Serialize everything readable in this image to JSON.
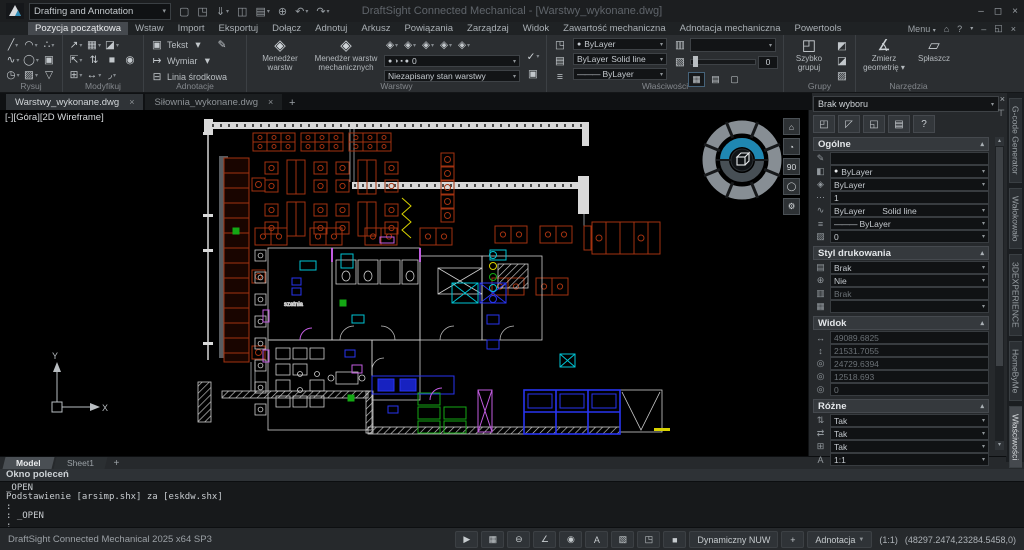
{
  "colors": {
    "accent_blue": "#1f87b2",
    "canvas_bg": "#000000",
    "equipment_red": "#a23210",
    "cyan": "#00c4d4",
    "blue": "#2834f0",
    "green": "#14a814",
    "magenta": "#c25ce0",
    "yellow": "#d8d200"
  },
  "titlebar": {
    "workspace": "Drafting and Annotation",
    "title": "DraftSight Connected Mechanical - [Warstwy_wykonane.dwg]",
    "qat": [
      [
        "▢",
        0
      ],
      [
        "◳",
        0
      ],
      [
        "⇓",
        1
      ],
      [
        "◫",
        0
      ],
      [
        "▤",
        1
      ],
      [
        "⊕",
        0
      ],
      [
        "↶",
        1
      ],
      [
        "↷",
        1
      ]
    ],
    "win": {
      "min": "–",
      "max": "◻",
      "close": "×"
    }
  },
  "menubar": {
    "tabs": [
      "Pozycja początkowa",
      "Wstaw",
      "Import",
      "Eksportuj",
      "Dołącz",
      "Adnotuj",
      "Arkusz",
      "Powiązania",
      "Zarządzaj",
      "Widok",
      "Zawartość mechaniczna",
      "Adnotacja mechaniczna",
      "Powertools"
    ],
    "active_index": 0,
    "menu_label": "Menu",
    "right_glyphs": [
      "▾",
      "⌂",
      "?",
      "▾",
      "–",
      "◱",
      "×"
    ]
  },
  "ribbon": {
    "labels": {
      "rysuj": "Rysuj",
      "modyfikuj": "Modyfikuj",
      "adnotacje": "Adnotacje",
      "warstwy": "Warstwy",
      "wlasciwosci": "Właściwości",
      "grupy": "Grupy",
      "narzedzia": "Narzędzia"
    },
    "rysuj_rows": [
      [
        [
          "╱",
          1
        ],
        [
          "◠",
          1
        ],
        [
          "∴",
          1
        ]
      ],
      [
        [
          "∿",
          1
        ],
        [
          "◯",
          1
        ],
        [
          "▣",
          0
        ]
      ],
      [
        [
          "◷",
          1
        ],
        [
          "▨",
          1
        ],
        [
          "▽",
          0
        ]
      ]
    ],
    "modyfikuj_rows": [
      [
        [
          "↗",
          1
        ],
        [
          "▦",
          1
        ],
        [
          "◪",
          1
        ]
      ],
      [
        [
          "⇱",
          1
        ],
        [
          "⇅",
          0
        ],
        [
          "■",
          0
        ],
        [
          "◉",
          0
        ]
      ],
      [
        [
          "⊞",
          1
        ],
        [
          "↔",
          1
        ],
        [
          "◞",
          1
        ]
      ]
    ],
    "adnotacje": {
      "tekst_icon": "▣",
      "tekst": "Tekst",
      "pen": "✎",
      "wymiar_icon": "↦",
      "wymiar": "Wymiar",
      "linia_icon": "⊟",
      "linia": "Linia środkowa"
    },
    "warstwy": {
      "btn1_line1": "Menedżer",
      "btn1_line2": "warstw",
      "btn1_icon": "◈",
      "btn2_line1": "Menedżer warstw",
      "btn2_line2": "mechanicznych",
      "btn2_icon": "◈",
      "small_icons": [
        [
          "◈",
          1
        ],
        [
          "◈",
          1
        ],
        [
          "◈",
          1
        ],
        [
          "◈",
          1
        ],
        [
          "◈",
          1
        ]
      ],
      "layer_glyphs": "● ◑ ▪ ●",
      "layer_value": "0",
      "check": "✓",
      "copy": "▣",
      "state_value": "Niezapisany stan warstwy"
    },
    "wlasciwosci": {
      "left_icons": [
        "◳",
        "▤",
        "≡"
      ],
      "color_dot": "●",
      "color_value": "ByLayer",
      "lt1": "ByLayer",
      "lt2": "Solid line",
      "lw_prefix": "———",
      "lw_value": "ByLayer",
      "right_icon": "▥",
      "slider_icon": "▧",
      "slider_value": "0",
      "toggles": [
        "▦",
        "▤",
        "▢"
      ]
    },
    "grupy": {
      "icon": "◰",
      "line1": "Szybko",
      "line2": "grupuj",
      "side_icons": [
        "◩",
        "◪",
        "▨"
      ]
    },
    "narzedzia": {
      "icon1": "∡",
      "btn1_line1": "Zmierz",
      "btn1_line2": "geometrię ▾",
      "icon2": "▱",
      "btn2": "Spłaszcz"
    }
  },
  "doc_tabs": [
    {
      "label": "Warstwy_wykonane.dwg",
      "active": true
    },
    {
      "label": "Siłownia_wykonane.dwg",
      "active": false
    }
  ],
  "doc_tab_add": "+",
  "canvas": {
    "viewport_label": "[-][Góra][2D Wireframe]",
    "plan_room_label": "szatnia",
    "ucs_x": "X",
    "ucs_y": "Y",
    "wheel_buttons": [
      "⌂",
      "◔",
      "90",
      "◯",
      "⚙"
    ]
  },
  "properties": {
    "selection": "Brak wyboru",
    "close": "×",
    "pin": "⊤",
    "toolbar": [
      [
        "◰",
        "select-entities-button"
      ],
      [
        "◸",
        "select-add-button"
      ],
      [
        "◱",
        "select-window-button"
      ],
      [
        "▤",
        "quick-select-button"
      ],
      [
        "?",
        "help-button"
      ]
    ],
    "sections": [
      {
        "title": "Ogólne",
        "rows": [
          {
            "icon": "✎",
            "name": "note",
            "value": "",
            "combo": false
          },
          {
            "icon": "◧",
            "name": "color",
            "dot": true,
            "value": "ByLayer",
            "combo": true
          },
          {
            "icon": "◈",
            "name": "layer",
            "value": "ByLayer",
            "combo": true
          },
          {
            "icon": "⋯",
            "name": "linetype-scale",
            "value": "1",
            "combo": false
          },
          {
            "icon": "∿",
            "name": "linetype",
            "value": "ByLayer",
            "value2": "Solid line",
            "combo": true
          },
          {
            "icon": "≡",
            "name": "lineweight",
            "prefix": "———",
            "value": "ByLayer",
            "combo": true
          },
          {
            "icon": "▨",
            "name": "transparency",
            "value": "0",
            "combo": true
          }
        ]
      },
      {
        "title": "Styl drukowania",
        "rows": [
          {
            "icon": "▤",
            "name": "print-style",
            "value": "Brak",
            "combo": true
          },
          {
            "icon": "⊕",
            "name": "print-table",
            "value": "Nie",
            "combo": true
          },
          {
            "icon": "▥",
            "name": "print-style-table",
            "value": "Brak",
            "gray": true
          },
          {
            "icon": "▦",
            "name": "print-table-attach",
            "value": "",
            "combo": true
          }
        ]
      },
      {
        "title": "Widok",
        "rows": [
          {
            "icon": "↔",
            "name": "view-width",
            "value": "49089.6825",
            "gray": true
          },
          {
            "icon": "↕",
            "name": "view-height",
            "value": "21531.7055",
            "gray": true
          },
          {
            "icon": "◎",
            "name": "center-x",
            "value": "24729.6394",
            "gray": true
          },
          {
            "icon": "◎",
            "name": "center-y",
            "value": "12518.693",
            "gray": true
          },
          {
            "icon": "◎",
            "name": "center-z",
            "value": "0",
            "gray": true
          }
        ]
      },
      {
        "title": "Różne",
        "rows": [
          {
            "icon": "⇅",
            "name": "ucs-icon-visible",
            "value": "Tak",
            "combo": true
          },
          {
            "icon": "⇄",
            "name": "ucs-icon-origin",
            "value": "Tak",
            "combo": true
          },
          {
            "icon": "⊞",
            "name": "ucs-per-viewport",
            "value": "Tak",
            "combo": true
          },
          {
            "icon": "A",
            "name": "annotation-scale",
            "value": "1:1",
            "combo": true
          }
        ]
      }
    ]
  },
  "side_tabs": {
    "tabs": [
      "G-code Generator",
      "Wałokowało",
      "3DEXPERIENCE",
      "HomeByMe"
    ],
    "active": "Właściwości"
  },
  "sheet_tabs": {
    "tabs": [
      {
        "label": "Model",
        "active": true
      },
      {
        "label": "Sheet1",
        "active": false
      }
    ],
    "add": "+"
  },
  "command": {
    "title": "Okno poleceń",
    "lines": [
      "_OPEN",
      "_OPEN",
      "Podstawienie [arsimp.shx] za [eskdw.shx]",
      ":",
      ": _OPEN",
      ":"
    ]
  },
  "statusbar": {
    "app": "DraftSight Connected Mechanical 2025  x64 SP3",
    "icons": [
      [
        "▶",
        "pointer-snap-toggle"
      ],
      [
        "▦",
        "grid-toggle"
      ],
      [
        "⊖",
        "ortho-toggle"
      ],
      [
        "∠",
        "polar-toggle"
      ],
      [
        "◉",
        "entity-snap-toggle"
      ],
      [
        "A",
        "entity-track-toggle"
      ],
      [
        "▧",
        "selection-filter-toggle"
      ],
      [
        "◳",
        "quick-input-toggle"
      ],
      [
        "■",
        "background-swatch"
      ]
    ],
    "dynamic": "Dynamiczny NUW",
    "plus": "+",
    "annotation": "Adnotacja",
    "scale": "(1:1)",
    "coords": "(48297.2474,23284.5458,0)"
  }
}
